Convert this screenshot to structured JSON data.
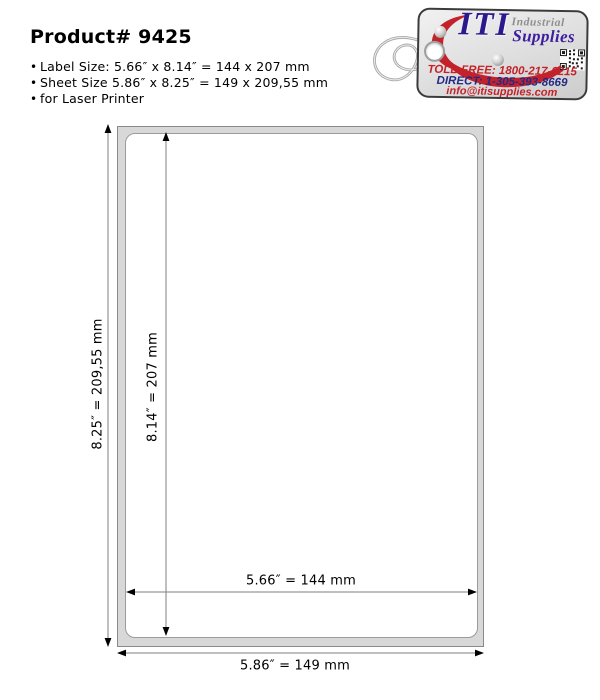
{
  "header": {
    "title": "Product# 9425"
  },
  "specs": [
    "Label Size: 5.66″ x 8.14″ = 144 x 207 mm",
    "Sheet Size 5.86″ x 8.25″ = 149 x 209,55 mm",
    "for Laser Printer"
  ],
  "logo": {
    "brand": "ITI",
    "brand_line1": "Industrial",
    "brand_line2": "Supplies",
    "toll_free": "TOLL-FREE: 1800-217-6215",
    "direct": "DIRECT: 1-305-393-8669",
    "email": "info@itisupplies.com",
    "colors": {
      "red": "#c4222a",
      "navy": "#2b188f",
      "purple": "#3c1e9e",
      "gray": "#8f8f8f"
    }
  },
  "diagram": {
    "sheet": {
      "width_label": "5.86″ = 149 mm",
      "height_label": "8.25″ = 209,55 mm"
    },
    "label": {
      "width_label": "5.66″ = 144 mm",
      "height_label": "8.14″ = 207 mm"
    }
  }
}
